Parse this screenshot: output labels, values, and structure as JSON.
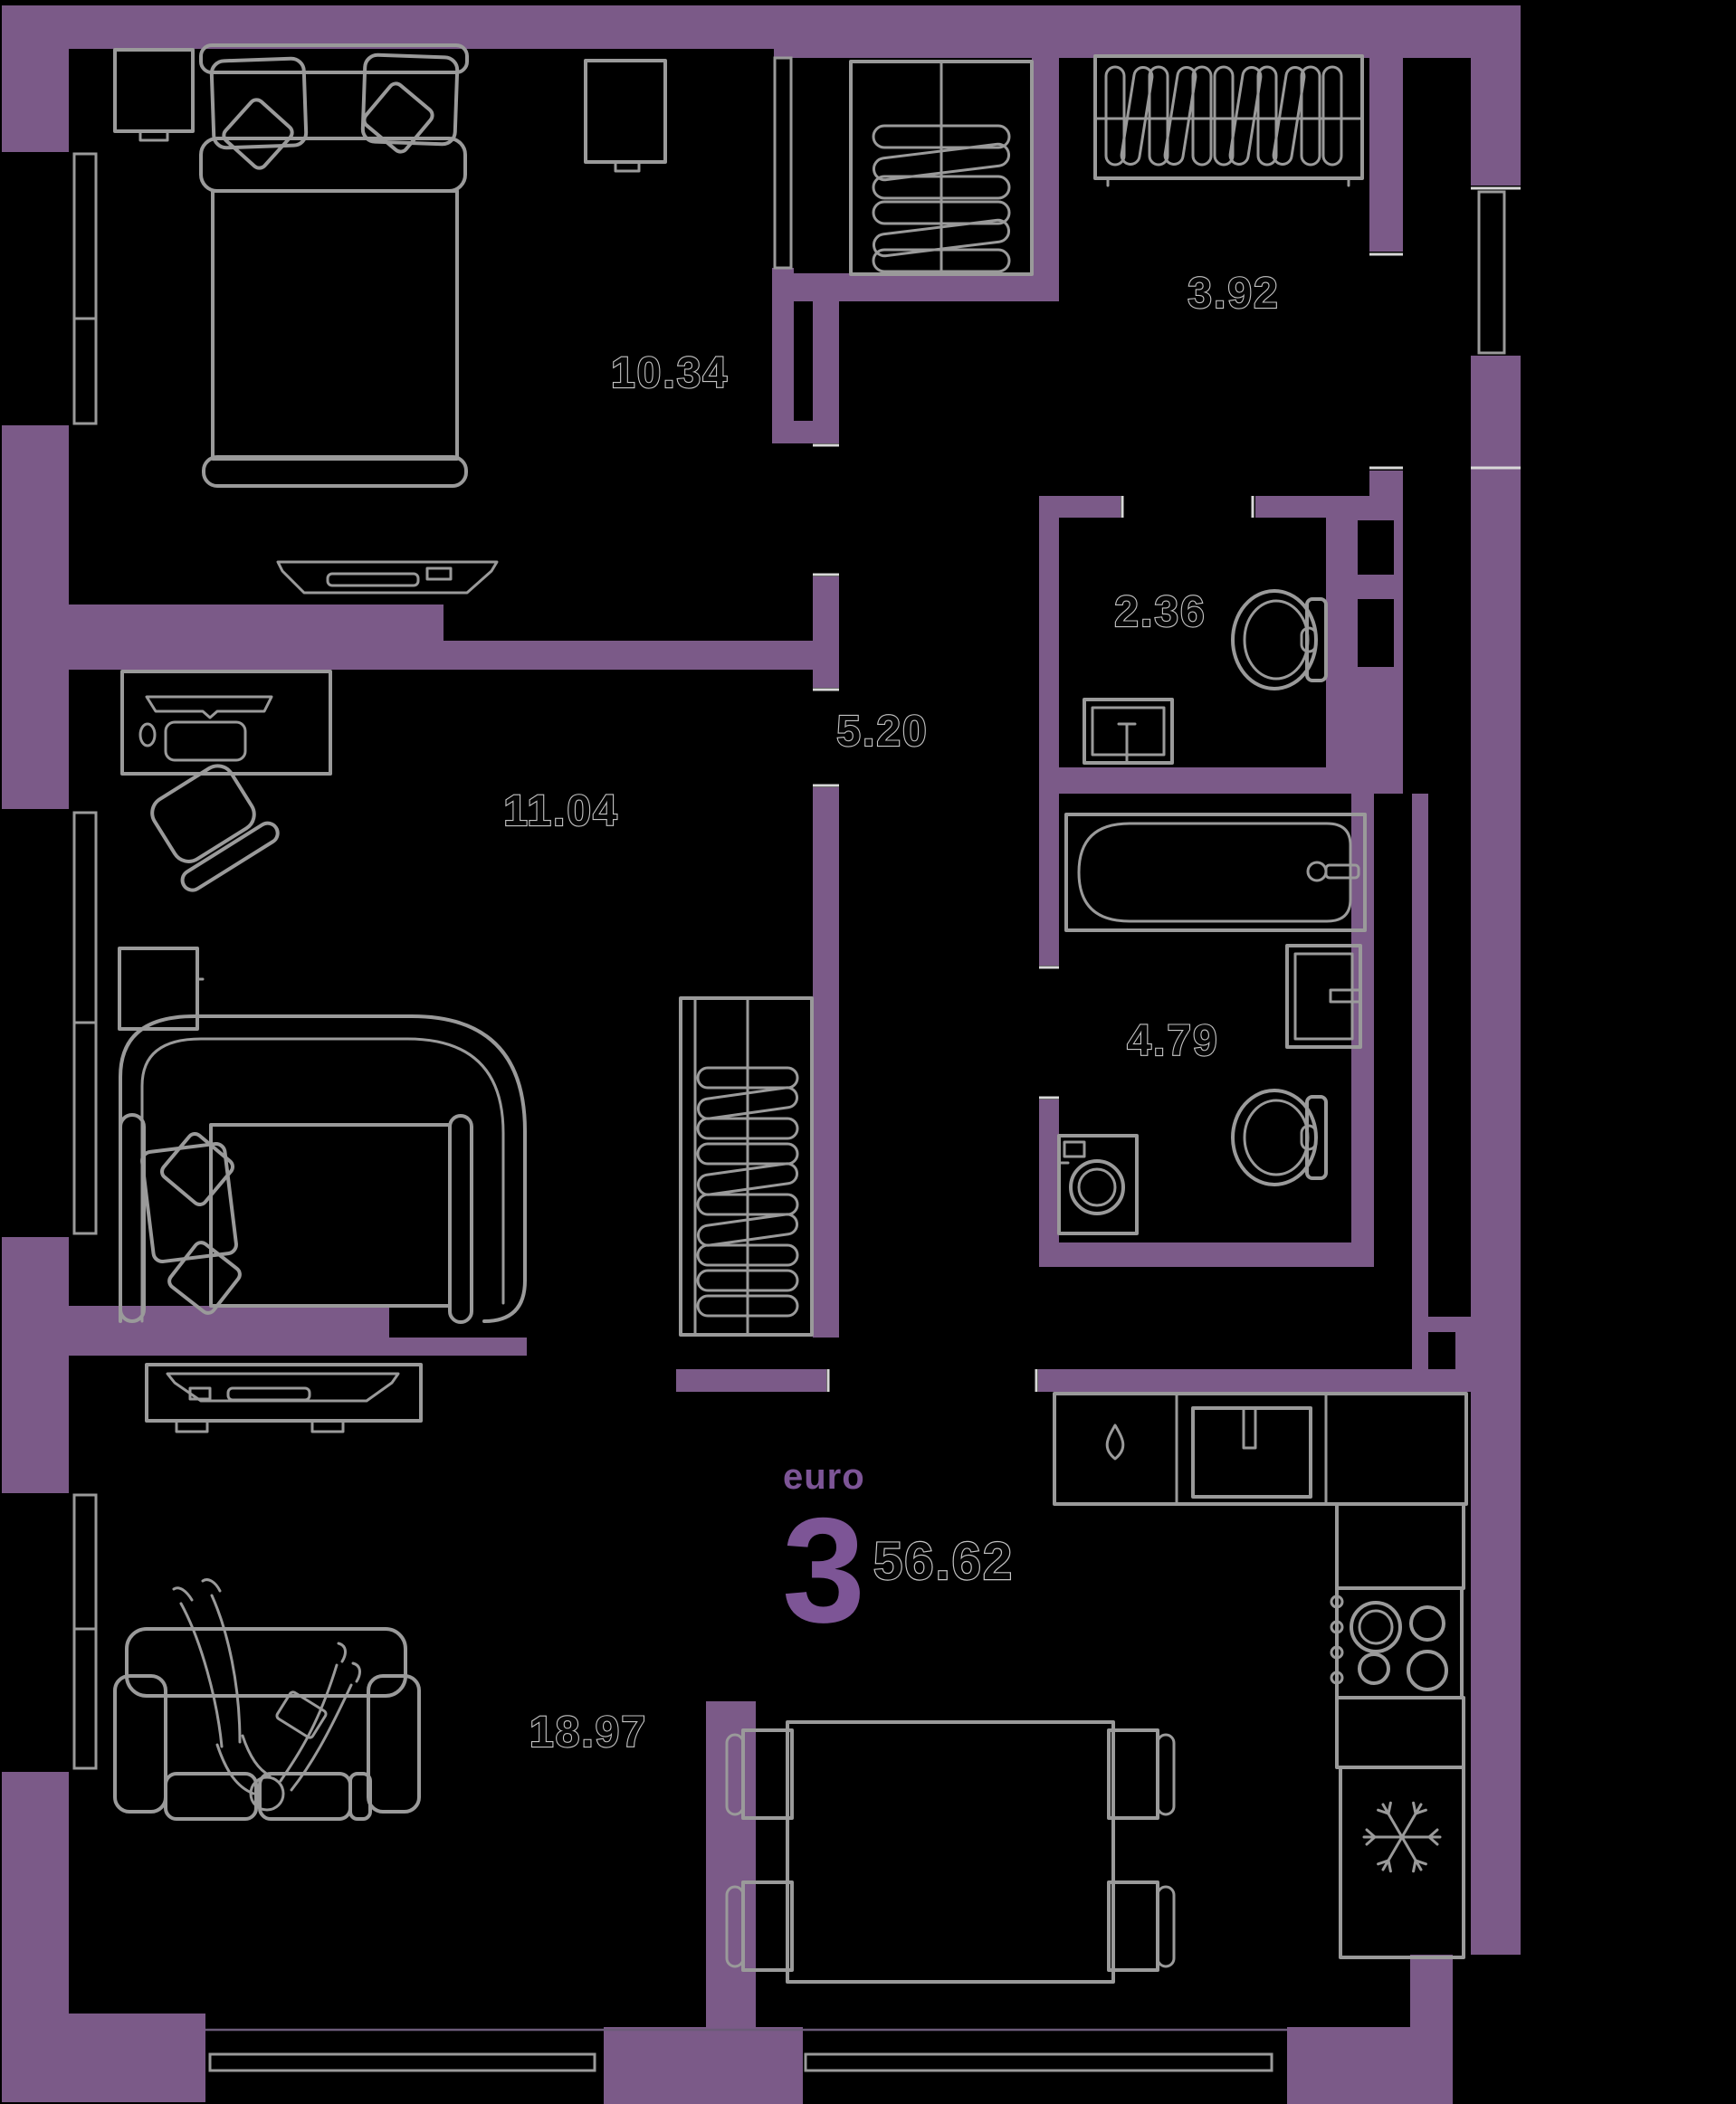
{
  "plan": {
    "unit_badge": {
      "format_label": "euro",
      "rooms_count": "3",
      "total_area_m2": "56.62"
    },
    "rooms": [
      {
        "name": "bedroom",
        "area_m2": "10.34"
      },
      {
        "name": "loggia",
        "area_m2": "3.92"
      },
      {
        "name": "water-closet",
        "area_m2": "2.36"
      },
      {
        "name": "hallway",
        "area_m2": "5.20"
      },
      {
        "name": "bedroom-2",
        "area_m2": "11.04"
      },
      {
        "name": "bathroom",
        "area_m2": "4.79"
      },
      {
        "name": "living-kitchen",
        "area_m2": "18.97"
      }
    ],
    "symbols": {
      "fridge": "snowflake",
      "sink_cabinet": "water-drop"
    },
    "colors": {
      "background": "#000000",
      "wall": "#7B5A88",
      "accent": "#7D5596",
      "line": "#9A9A9A",
      "label_outline": "#C4C4C4",
      "exterior_line": "#6B5B78"
    }
  }
}
